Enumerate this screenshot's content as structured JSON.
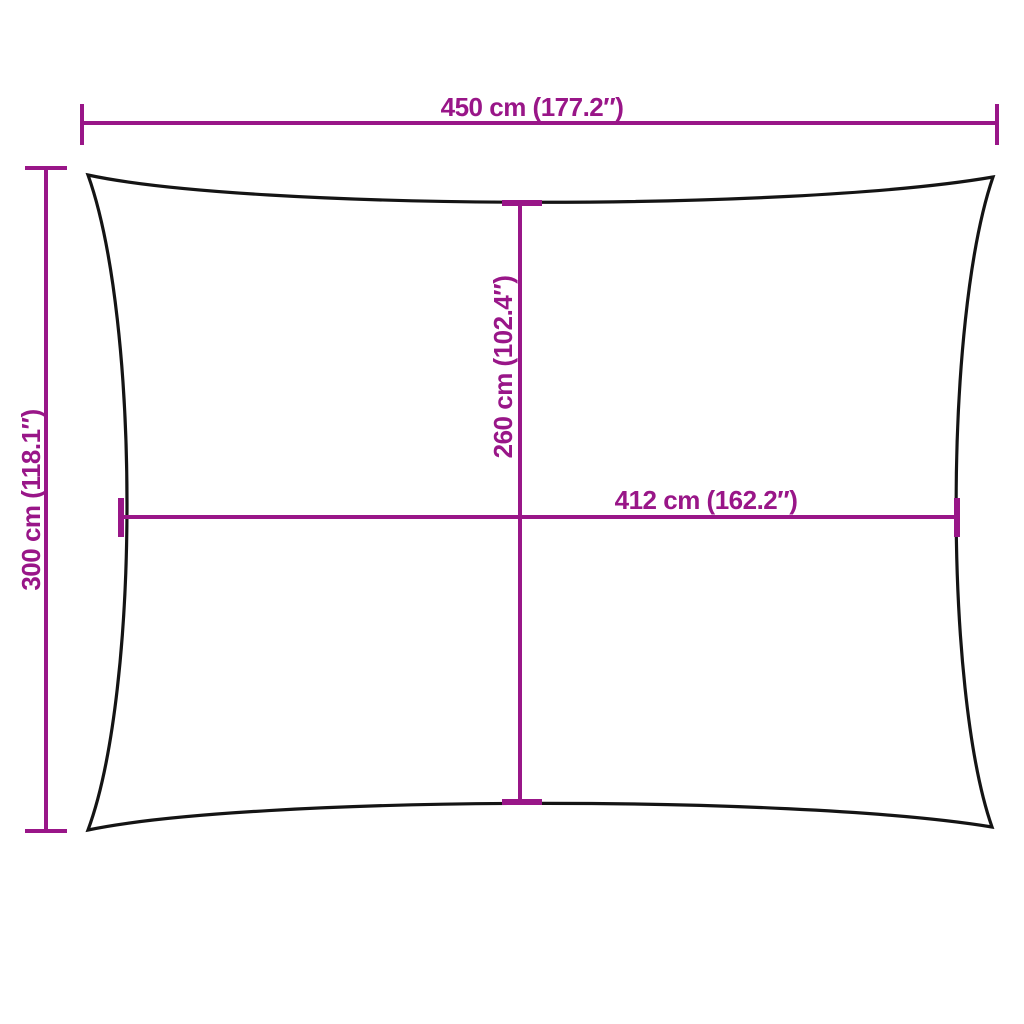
{
  "diagram": {
    "colors": {
      "dimension_color": "#991688",
      "outline_color": "#141414",
      "background": "#ffffff"
    },
    "labels": {
      "overall_width": "450 cm (177.2″)",
      "overall_height": "300 cm (118.1″)",
      "inner_height": "260 cm (102.4″)",
      "inner_width": "412 cm (162.2″)"
    }
  }
}
